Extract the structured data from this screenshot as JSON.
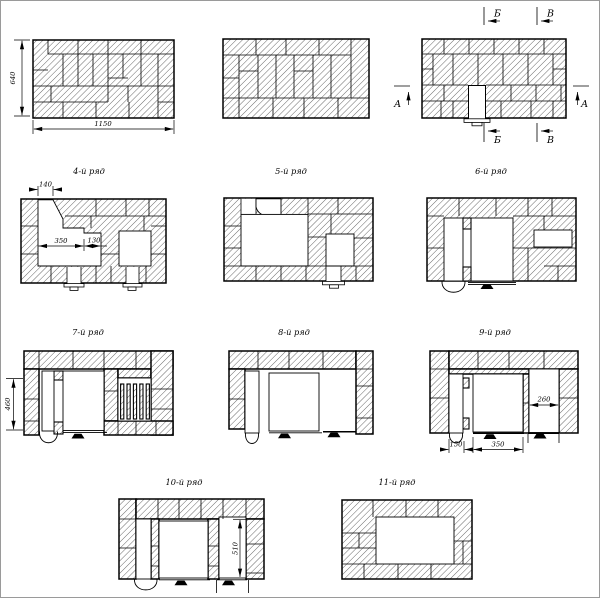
{
  "diagram": {
    "course1": {
      "dim_height": "640",
      "dim_width": "1150"
    },
    "course3": {
      "mark_a": "А",
      "mark_b": "Б",
      "mark_v": "В"
    },
    "course4": {
      "title": "4-й ряд",
      "dim_notch": "140",
      "dim_chamber": "350",
      "dim_step": "130"
    },
    "course5": {
      "title": "5-й ряд"
    },
    "course6": {
      "title": "6-й ряд"
    },
    "course7": {
      "title": "7-й ряд",
      "dim_height": "460"
    },
    "course8": {
      "title": "8-й ряд"
    },
    "course9": {
      "title": "9-й ряд",
      "dim_right": "260",
      "dim_door": "150",
      "dim_chamber": "350"
    },
    "course10": {
      "title": "10-й ряд",
      "dim_height": "510"
    },
    "course11": {
      "title": "11-й ряд"
    },
    "colors": {
      "line": "#000000",
      "background": "#ffffff"
    }
  }
}
